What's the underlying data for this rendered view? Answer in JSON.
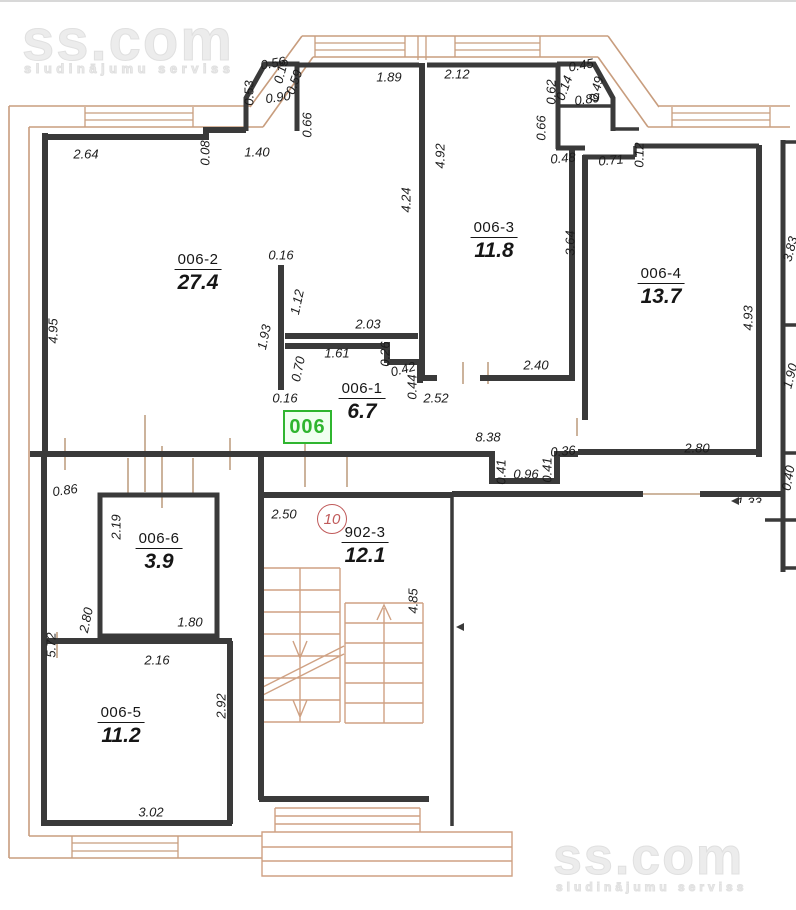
{
  "colors": {
    "wall": "#3a3a3a",
    "tan": "#c89d7e",
    "stair": "#cfa183",
    "tick": "#b08a66",
    "green": "#2fb52f",
    "green-bg": "#f1fff1",
    "red": "#c05a5a",
    "dim": "#1c1c1c",
    "watermark": "#ececec"
  },
  "watermark": {
    "brand": "ss.com",
    "tagline": "sludinājumu serviss"
  },
  "badges": {
    "unit": "006",
    "floor": "10"
  },
  "rooms": [
    {
      "name": "006-2",
      "area": "27.4",
      "x": 198,
      "y": 273
    },
    {
      "name": "006-3",
      "area": "11.8",
      "x": 494,
      "y": 241
    },
    {
      "name": "006-4",
      "area": "13.7",
      "x": 661,
      "y": 287
    },
    {
      "name": "006-1",
      "area": "6.7",
      "x": 362,
      "y": 402
    },
    {
      "name": "006-6",
      "area": "3.9",
      "x": 159,
      "y": 552
    },
    {
      "name": "006-5",
      "area": "11.2",
      "x": 121,
      "y": 726
    },
    {
      "name": "902-3",
      "area": "12.1",
      "x": 365,
      "y": 546
    }
  ],
  "dimensions": [
    {
      "t": "2.64",
      "x": 86,
      "y": 154,
      "r": 0
    },
    {
      "t": "0.08",
      "x": 205,
      "y": 153,
      "r": -90
    },
    {
      "t": "1.40",
      "x": 257,
      "y": 152,
      "r": 0
    },
    {
      "t": "0.53",
      "x": 249,
      "y": 93,
      "r": -90
    },
    {
      "t": "0.56",
      "x": 273,
      "y": 63,
      "r": -10
    },
    {
      "t": "0.15",
      "x": 281,
      "y": 71,
      "r": -75
    },
    {
      "t": "0.59",
      "x": 294,
      "y": 82,
      "r": -70
    },
    {
      "t": "0.90",
      "x": 278,
      "y": 97,
      "r": -8
    },
    {
      "t": "0.66",
      "x": 307,
      "y": 125,
      "r": -90
    },
    {
      "t": "1.89",
      "x": 389,
      "y": 77,
      "r": 0
    },
    {
      "t": "2.12",
      "x": 457,
      "y": 74,
      "r": 0
    },
    {
      "t": "0.62",
      "x": 551,
      "y": 92,
      "r": -90
    },
    {
      "t": "0.14",
      "x": 564,
      "y": 88,
      "r": -70
    },
    {
      "t": "0.45",
      "x": 581,
      "y": 65,
      "r": -10
    },
    {
      "t": "0.49",
      "x": 596,
      "y": 89,
      "r": -75
    },
    {
      "t": "0.89",
      "x": 587,
      "y": 99,
      "r": -8
    },
    {
      "t": "0.66",
      "x": 541,
      "y": 128,
      "r": -90
    },
    {
      "t": "0.48",
      "x": 563,
      "y": 158,
      "r": -5
    },
    {
      "t": "0.71",
      "x": 611,
      "y": 160,
      "r": -5
    },
    {
      "t": "0.12",
      "x": 639,
      "y": 155,
      "r": -90
    },
    {
      "t": "4.92",
      "x": 440,
      "y": 156,
      "r": -90
    },
    {
      "t": "4.24",
      "x": 406,
      "y": 200,
      "r": -90
    },
    {
      "t": "4.95",
      "x": 53,
      "y": 331,
      "r": -90
    },
    {
      "t": "0.16",
      "x": 281,
      "y": 255,
      "r": 0
    },
    {
      "t": "1.12",
      "x": 297,
      "y": 302,
      "r": -78
    },
    {
      "t": "1.93",
      "x": 264,
      "y": 337,
      "r": -78
    },
    {
      "t": "2.03",
      "x": 368,
      "y": 324,
      "r": 0
    },
    {
      "t": "1.61",
      "x": 337,
      "y": 353,
      "r": 0
    },
    {
      "t": "0.26",
      "x": 385,
      "y": 354,
      "r": -90
    },
    {
      "t": "0.70",
      "x": 298,
      "y": 369,
      "r": -78
    },
    {
      "t": "0.42",
      "x": 403,
      "y": 369,
      "r": -15
    },
    {
      "t": "0.44",
      "x": 412,
      "y": 387,
      "r": -90
    },
    {
      "t": "0.16",
      "x": 285,
      "y": 398,
      "r": 0
    },
    {
      "t": "2.52",
      "x": 436,
      "y": 398,
      "r": 0
    },
    {
      "t": "3.64",
      "x": 570,
      "y": 243,
      "r": -90
    },
    {
      "t": "2.40",
      "x": 536,
      "y": 365,
      "r": 0
    },
    {
      "t": "8.38",
      "x": 488,
      "y": 437,
      "r": 0
    },
    {
      "t": "0.41",
      "x": 501,
      "y": 472,
      "r": -90
    },
    {
      "t": "0.96",
      "x": 526,
      "y": 474,
      "r": 0
    },
    {
      "t": "0.41",
      "x": 547,
      "y": 470,
      "r": -90
    },
    {
      "t": "0.36",
      "x": 563,
      "y": 451,
      "r": -5
    },
    {
      "t": "2.80",
      "x": 697,
      "y": 448,
      "r": 0
    },
    {
      "t": "4.93",
      "x": 748,
      "y": 318,
      "r": -90
    },
    {
      "t": "0.86",
      "x": 65,
      "y": 490,
      "r": -8
    },
    {
      "t": "2.19",
      "x": 116,
      "y": 527,
      "r": -90
    },
    {
      "t": "2.80",
      "x": 86,
      "y": 620,
      "r": -78
    },
    {
      "t": "1.80",
      "x": 190,
      "y": 622,
      "r": 0
    },
    {
      "t": "2.16",
      "x": 157,
      "y": 660,
      "r": 0
    },
    {
      "t": "5.72",
      "x": 51,
      "y": 645,
      "r": -90
    },
    {
      "t": "2.92",
      "x": 221,
      "y": 706,
      "r": -90
    },
    {
      "t": "3.02",
      "x": 151,
      "y": 812,
      "r": 0
    },
    {
      "t": "2.50",
      "x": 284,
      "y": 514,
      "r": 0
    },
    {
      "t": "4.85",
      "x": 413,
      "y": 601,
      "r": -90
    },
    {
      "t": "3.83",
      "x": 790,
      "y": 249,
      "r": -75
    },
    {
      "t": "1.90",
      "x": 790,
      "y": 376,
      "r": -75
    },
    {
      "t": "0.40",
      "x": 788,
      "y": 478,
      "r": -80
    },
    {
      "t": "1.33",
      "x": 749,
      "y": 502,
      "r": 0,
      "c": 1
    }
  ]
}
